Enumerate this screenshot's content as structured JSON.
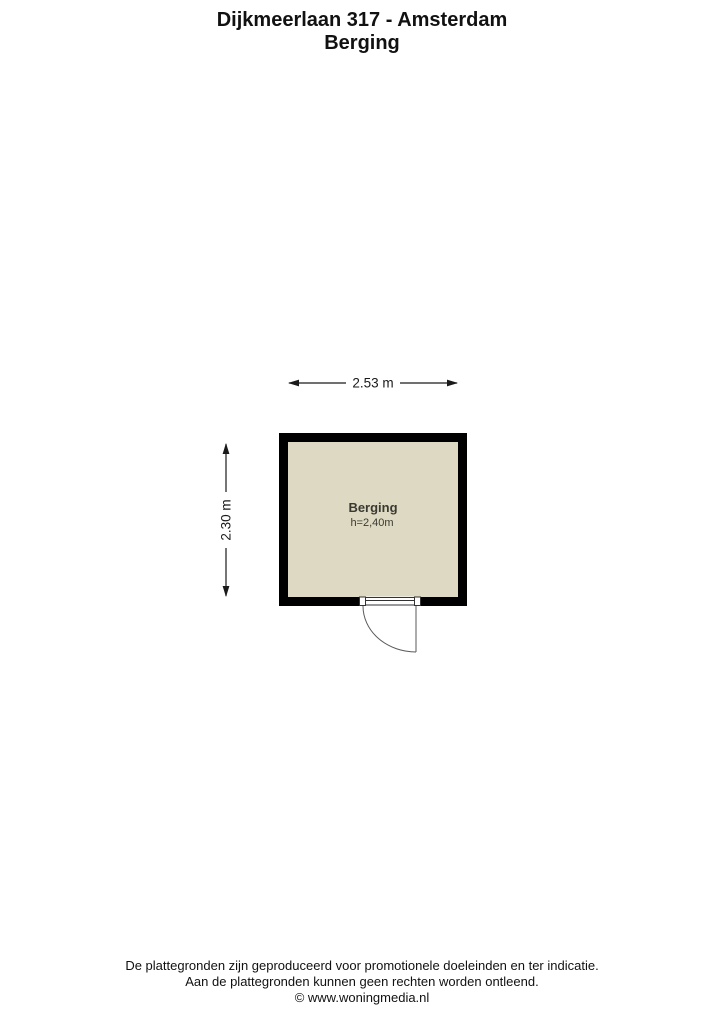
{
  "title": {
    "line1": "Dijkmeerlaan 317 - Amsterdam",
    "line2": "Berging"
  },
  "floor_plan": {
    "room_name": "Berging",
    "room_height_label": "h=2,40m",
    "dim_width_label": "2.53 m",
    "dim_height_label": "2.30 m",
    "colors": {
      "wall": "#000000",
      "floor": "#ded9c2",
      "door_line": "#5a5a5a",
      "dimension": "#1a1a1a",
      "label_text": "#3a3a32"
    }
  },
  "footer": {
    "line1": "De plattegronden zijn geproduceerd voor promotionele doeleinden en ter indicatie.",
    "line2": "Aan de plattegronden kunnen geen rechten worden ontleend.",
    "line3": "© www.woningmedia.nl"
  }
}
